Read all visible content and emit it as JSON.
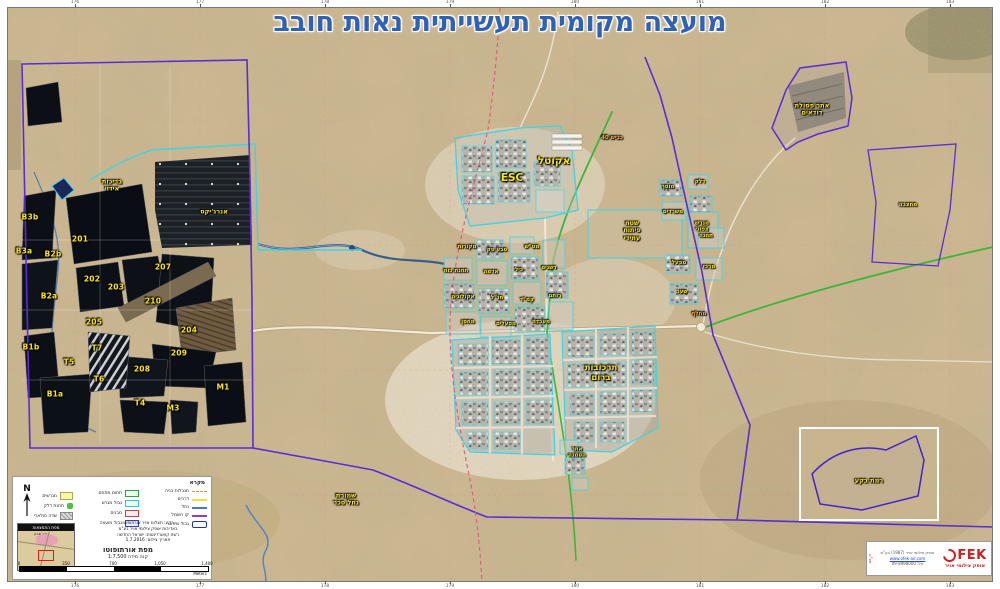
{
  "title": "מועצה מקומית תעשייתית נאות חובב",
  "frame": {
    "ticks": [
      "176",
      "177",
      "178",
      "179",
      "180",
      "181",
      "182",
      "183"
    ]
  },
  "map": {
    "labels": [
      {
        "t": "B3b",
        "x": 30,
        "y": 218,
        "c": "pond"
      },
      {
        "t": "B3a",
        "x": 24,
        "y": 252,
        "c": "pond"
      },
      {
        "t": "B2b",
        "x": 53,
        "y": 255,
        "c": "pond"
      },
      {
        "t": "B2a",
        "x": 49,
        "y": 297,
        "c": "pond"
      },
      {
        "t": "B1b",
        "x": 31,
        "y": 348,
        "c": "pond"
      },
      {
        "t": "B1a",
        "x": 55,
        "y": 395,
        "c": "pond"
      },
      {
        "t": "201",
        "x": 80,
        "y": 240,
        "c": "pond"
      },
      {
        "t": "202",
        "x": 92,
        "y": 280,
        "c": "pond"
      },
      {
        "t": "203",
        "x": 116,
        "y": 288,
        "c": "pond"
      },
      {
        "t": "205",
        "x": 94,
        "y": 323,
        "c": "pond"
      },
      {
        "t": "210",
        "x": 153,
        "y": 302,
        "c": "pond"
      },
      {
        "t": "207",
        "x": 163,
        "y": 268,
        "c": "pond"
      },
      {
        "t": "204",
        "x": 189,
        "y": 331,
        "c": "pond"
      },
      {
        "t": "209",
        "x": 179,
        "y": 354,
        "c": "pond"
      },
      {
        "t": "208",
        "x": 142,
        "y": 370,
        "c": "pond"
      },
      {
        "t": "T7",
        "x": 97,
        "y": 349,
        "c": "pond"
      },
      {
        "t": "T5",
        "x": 69,
        "y": 363,
        "c": "pond"
      },
      {
        "t": "T6",
        "x": 99,
        "y": 380,
        "c": "pond"
      },
      {
        "t": "T4",
        "x": 140,
        "y": 404,
        "c": "pond"
      },
      {
        "t": "M1",
        "x": 223,
        "y": 388,
        "c": "pond"
      },
      {
        "t": "M3",
        "x": 173,
        "y": 409,
        "c": "pond"
      },
      {
        "t": "בריכות\nאידוי",
        "x": 112,
        "y": 186,
        "c": "small"
      },
      {
        "t": "אנרג'יקס",
        "x": 214,
        "y": 212,
        "c": "small"
      },
      {
        "t": "אקוטל",
        "x": 554,
        "y": 161,
        "c": "big"
      },
      {
        "t": "ESC",
        "x": 512,
        "y": 178,
        "c": "big"
      },
      {
        "t": "תרכובות\nברום",
        "x": 601,
        "y": 374,
        "c": "med"
      },
      {
        "t": "שטח\nפיתוח\nעתידי",
        "x": 632,
        "y": 231,
        "c": "small"
      },
      {
        "t": "מגרש\nצפוני",
        "x": 702,
        "y": 227,
        "c": "tiny"
      },
      {
        "t": "אתר פסולת\nדודאים",
        "x": 812,
        "y": 110,
        "c": "small"
      },
      {
        "t": "מחצבה",
        "x": 908,
        "y": 205,
        "c": "tiny"
      },
      {
        "t": "שמורת\nנחל סכר",
        "x": 346,
        "y": 500,
        "c": "small"
      },
      {
        "t": "רמת בקע",
        "x": 869,
        "y": 481,
        "c": "small"
      },
      {
        "t": "מחלף",
        "x": 699,
        "y": 314,
        "c": "tiny orange"
      },
      {
        "t": "אתר\nהטמנה",
        "x": 577,
        "y": 453,
        "c": "tiny"
      },
      {
        "t": "כביש 40",
        "x": 612,
        "y": 138,
        "c": "tiny orange"
      },
      {
        "t": "מקורות",
        "x": 467,
        "y": 247,
        "c": "tiny"
      },
      {
        "t": "טבע טק",
        "x": 497,
        "y": 250,
        "c": "tiny"
      },
      {
        "t": "מט\"ש",
        "x": 532,
        "y": 247,
        "c": "tiny"
      },
      {
        "t": "תחנת כוח",
        "x": 456,
        "y": 271,
        "c": "tiny"
      },
      {
        "t": "אדמה",
        "x": 491,
        "y": 272,
        "c": "tiny"
      },
      {
        "t": "כיל",
        "x": 519,
        "y": 270,
        "c": "tiny"
      },
      {
        "t": "דשנים",
        "x": 549,
        "y": 268,
        "c": "tiny"
      },
      {
        "t": "אקולוגיה",
        "x": 463,
        "y": 297,
        "c": "tiny"
      },
      {
        "t": "חנ\"ל",
        "x": 497,
        "y": 298,
        "c": "tiny"
      },
      {
        "t": "קמ\"ד",
        "x": 527,
        "y": 300,
        "c": "tiny"
      },
      {
        "t": "רותם",
        "x": 555,
        "y": 296,
        "c": "tiny"
      },
      {
        "t": "מחסן",
        "x": 468,
        "y": 322,
        "c": "tiny"
      },
      {
        "t": "מפעלים",
        "x": 506,
        "y": 324,
        "c": "tiny"
      },
      {
        "t": "מעבדה",
        "x": 541,
        "y": 322,
        "c": "tiny"
      },
      {
        "t": "מוסך",
        "x": 668,
        "y": 187,
        "c": "tiny"
      },
      {
        "t": "דלק",
        "x": 700,
        "y": 182,
        "c": "tiny"
      },
      {
        "t": "משרדים",
        "x": 673,
        "y": 212,
        "c": "tiny"
      },
      {
        "t": "תחנה",
        "x": 706,
        "y": 236,
        "c": "tiny"
      },
      {
        "t": "מפעל",
        "x": 679,
        "y": 263,
        "c": "tiny"
      },
      {
        "t": "מרכז",
        "x": 709,
        "y": 267,
        "c": "tiny"
      },
      {
        "t": "שער",
        "x": 682,
        "y": 292,
        "c": "tiny"
      }
    ]
  },
  "legend": {
    "title": "מקרא",
    "line_items": [
      {
        "label": "מגבלות בניה"
      },
      {
        "label": "דרכים"
      },
      {
        "label": "נחל"
      },
      {
        "label": "קו חשמל"
      },
      {
        "label": "גבול שיפוט"
      }
    ],
    "box_items": [
      {
        "label": "תחום מתחם"
      },
      {
        "label": "גבול מגרש"
      },
      {
        "label": "מבנים"
      },
      {
        "label": "גבול מועצה"
      }
    ],
    "area_items": [
      {
        "label": "מגרשים"
      },
      {
        "label": "תחנת דלק"
      },
      {
        "label": "שדה סולארי"
      }
    ]
  },
  "inset": {
    "title": "מפת התמצאות",
    "city": "באר שבע"
  },
  "notes": {
    "l1": "רקע: תצלום אויר אורתופוטו",
    "l2": "באדיבות אופק צילומי אויר בע\"מ",
    "l3": "רשת קואורדינטות: ישראל החדשה",
    "l4": "תאריך צילום: 1.7.2016"
  },
  "scale": {
    "map_type": "מפת אורתופוטו",
    "text": "קנה מידה 1:7,500",
    "n0": "0",
    "n1": "350",
    "n2": "700",
    "n3": "1,050",
    "n4": "1,400",
    "unit": "Meters"
  },
  "logo": {
    "name": "FEK",
    "tagline": "אופק צילומי אויר",
    "line1": "אופק צילומי אויר (1987) בע\"מ",
    "line2": "www.ofek-air.com",
    "line3": "טל: 09-8998000",
    "vert": "תצ\"א"
  },
  "colors": {
    "plot_outline": "#3cd4e8",
    "jurisdiction": "#5b2bd6",
    "route": "#3db53d",
    "label_yellow": "#ffe900",
    "title_blue": "#2f62b5"
  }
}
